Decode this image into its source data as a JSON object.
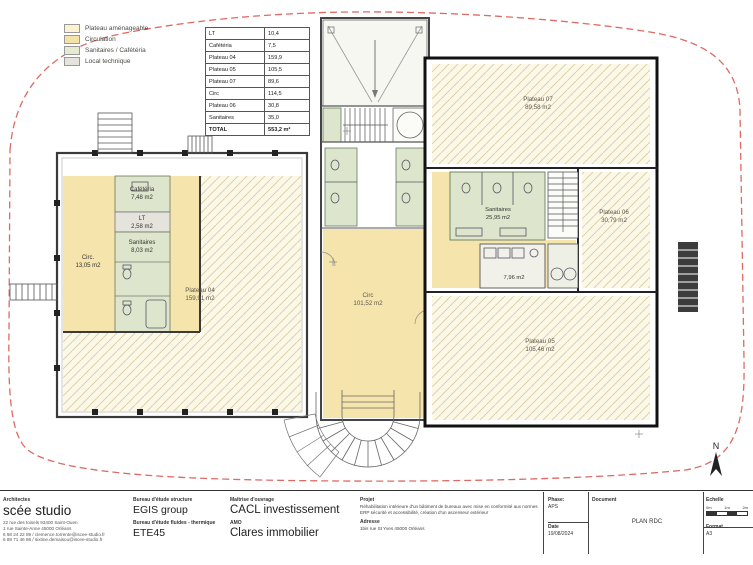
{
  "legend": {
    "items": [
      {
        "label": "Plateau aménageable",
        "color": "#fbf3cf"
      },
      {
        "label": "Circulation",
        "color": "#f3e3a9"
      },
      {
        "label": "Sanitaires / Cafétéria",
        "color": "#e6ebcf"
      },
      {
        "label": "Local technique",
        "color": "#e4e4dc"
      }
    ]
  },
  "area_table": {
    "rows": [
      {
        "label": "LT",
        "value": "10,4"
      },
      {
        "label": "Cafétéria",
        "value": "7,5"
      },
      {
        "label": "Plateau 04",
        "value": "159,9"
      },
      {
        "label": "Plateau 05",
        "value": "105,5"
      },
      {
        "label": "Plateau 07",
        "value": "89,6"
      },
      {
        "label": "Circ",
        "value": "114,5"
      },
      {
        "label": "Plateau 06",
        "value": "30,8"
      },
      {
        "label": "Sanitaires",
        "value": "35,0"
      },
      {
        "label": "TOTAL",
        "value": "553,2 m²"
      }
    ]
  },
  "plan": {
    "north_label": "N",
    "rooms": [
      {
        "name": "Cafétéria",
        "area": "7,48 m2"
      },
      {
        "name": "LT",
        "area": "2,58 m2"
      },
      {
        "name": "Sanitaires",
        "area": "8,03 m2"
      },
      {
        "name": "Circ.",
        "area": "13,05 m2"
      },
      {
        "name": "Plateau 04",
        "area": "159,91 m2"
      },
      {
        "name": "Circ",
        "area": "101,52 m2"
      },
      {
        "name": "Plateau 07",
        "area": "89,58 m2"
      },
      {
        "name": "Sanitaires",
        "area": "25,95 m2"
      },
      {
        "name": "",
        "area": "7,96 m2"
      },
      {
        "name": "Plateau 06",
        "area": "30,79 m2"
      },
      {
        "name": "Plateau 05",
        "area": "105,46 m2"
      }
    ],
    "colors": {
      "plateau_hatch": "#fcf8e8",
      "hatch_line": "#d9cda2",
      "circulation": "#f5e5ad",
      "sanitaires": "#dde6cc",
      "local_technique": "#e4e4dc",
      "site_boundary": "#dd6b63"
    }
  },
  "title_block": {
    "architect": {
      "heading": "Architectes",
      "name": "scée studio",
      "address_lines": [
        "22 rue des toisels 93400 Saint-Ouen",
        "1 rue Sainte-Anne 45000 Orléans",
        "6 68 24 22 89 / clemence.torrente@iscee-studio.fr",
        "6 89 71 46 86 / sixtine.demaisou@iscee-studio.fr"
      ]
    },
    "structure": {
      "heading": "Bureau d'étude structure",
      "name": "EGIS group"
    },
    "fluids": {
      "heading": "Bureau d'étude fluides - thermique",
      "name": "ETE45"
    },
    "owner": {
      "heading": "Maîtrise d'ouvrage",
      "name": "CACL investissement"
    },
    "amo": {
      "heading": "AMO",
      "name": "Clares immobilier"
    },
    "project": {
      "heading": "Projet",
      "text": "Réhabilitation intérieure d'un bâtiment de bureaux avec mise en conformité aux normes ERP sécurité et accessibilité, création d'un ascenseur extérieur"
    },
    "site_address": {
      "heading": "Adresse",
      "text": "1bis rue St Yves 45000 Orléans"
    },
    "phase": {
      "heading": "Phase:",
      "value": "APS"
    },
    "date": {
      "heading": "Date",
      "value": "19/08/2024"
    },
    "document": {
      "heading": "Document",
      "value": "PLAN RDC"
    },
    "scale": {
      "heading": "Echelle",
      "ticks": [
        "0m",
        "1m",
        "2m"
      ]
    },
    "format": {
      "heading": "Format",
      "value": "A3"
    }
  }
}
